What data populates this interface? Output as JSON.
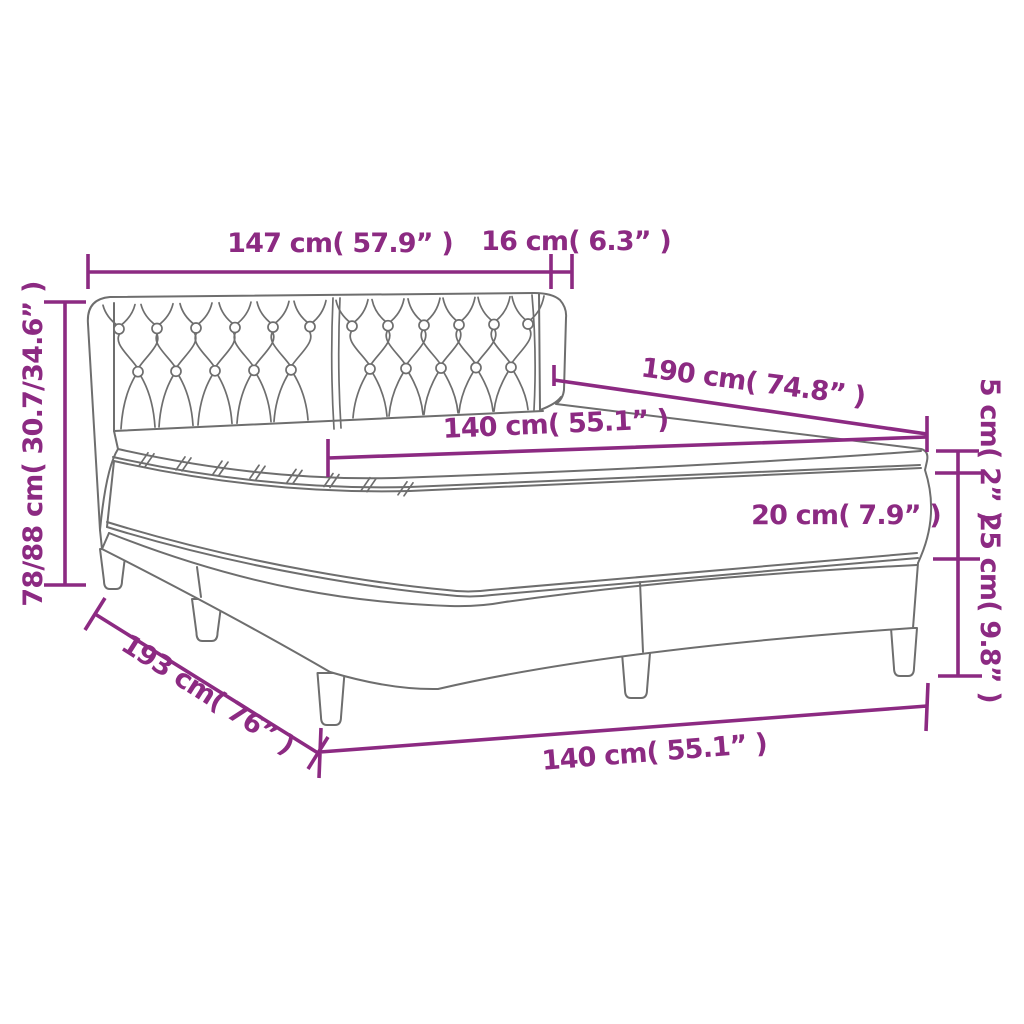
{
  "diagram": {
    "subject": "box-spring-bed-dimension-diagram",
    "colors": {
      "dimension": "#8C2A82",
      "art_line": "#6E6E6E",
      "background": "#FFFFFF"
    },
    "dimensions": {
      "headboard_width": "147 cm( 57.9” )",
      "headboard_depth": "16 cm( 6.3” )",
      "total_height": "78/88 cm( 30.7/34.6” )",
      "length_top": "190 cm( 74.8” )",
      "width_top": "140 cm( 55.1” )",
      "topper_height": "5 cm( 2” )",
      "mattress_height": "20 cm( 7.9” )",
      "base_height": "25 cm( 9.8” )",
      "length_bottom": "193 cm( 76” )",
      "width_bottom": "140 cm( 55.1” )"
    }
  }
}
